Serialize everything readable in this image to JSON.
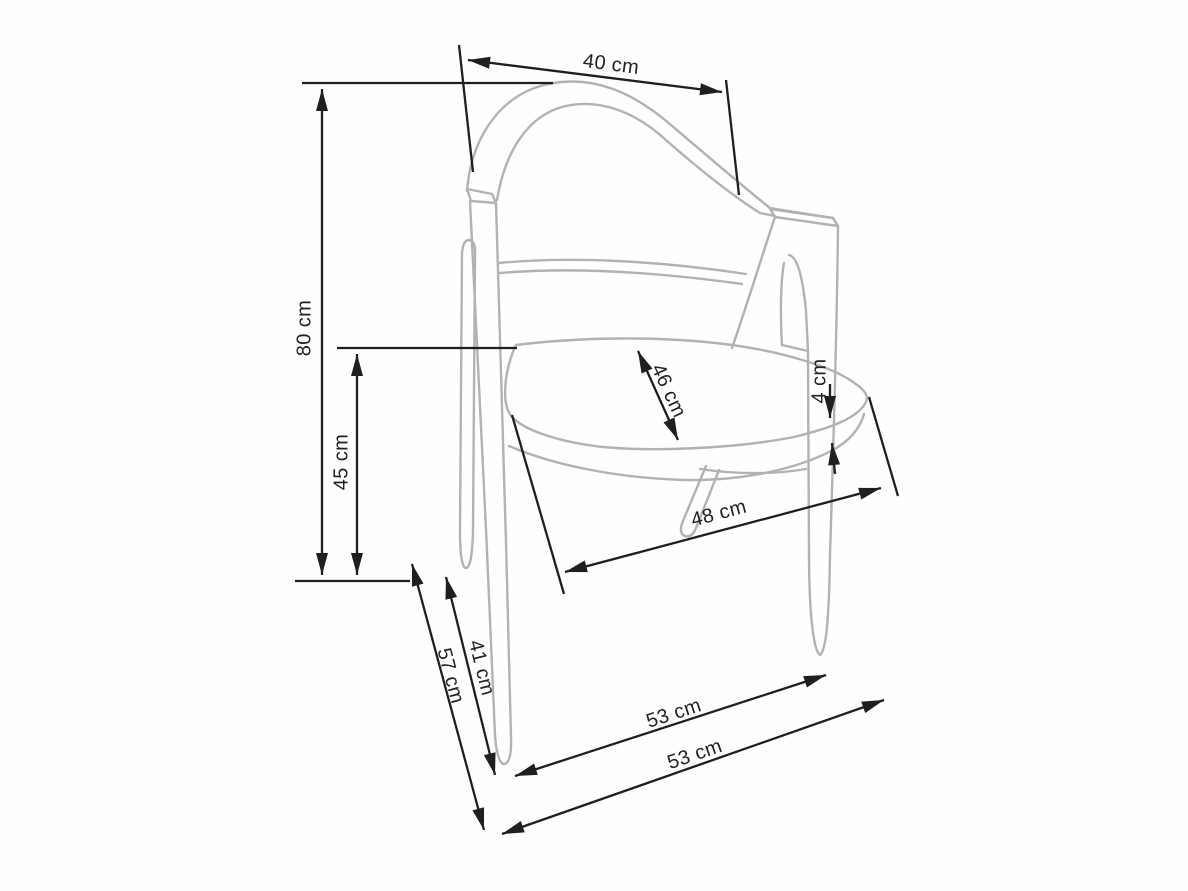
{
  "diagram": {
    "kind": "chair dimensional technical drawing",
    "background": "#fefefe",
    "dimension_line_color": "#1f1f1f",
    "chair_line_color": "#b2b2b2"
  },
  "labels": {
    "dim_40": "40 cm",
    "dim_80": "80 cm",
    "dim_45": "45 cm",
    "dim_46": "46 cm",
    "dim_4": "4 cm",
    "dim_48": "48 cm",
    "dim_41": "41 cm",
    "dim_57": "57 cm",
    "dim_53_upper": "53 cm",
    "dim_53_lower": "53 cm"
  },
  "measurements": {
    "back_width_cm": 40,
    "total_height_cm": 80,
    "seat_height_cm": 45,
    "seat_depth_cm": 46,
    "seat_thickness_cm": 4,
    "seat_width_cm": 48,
    "leg_depth_cm": 41,
    "total_depth_cm": 57,
    "base_width_front_cm": 53,
    "base_width_outer_cm": 53
  }
}
